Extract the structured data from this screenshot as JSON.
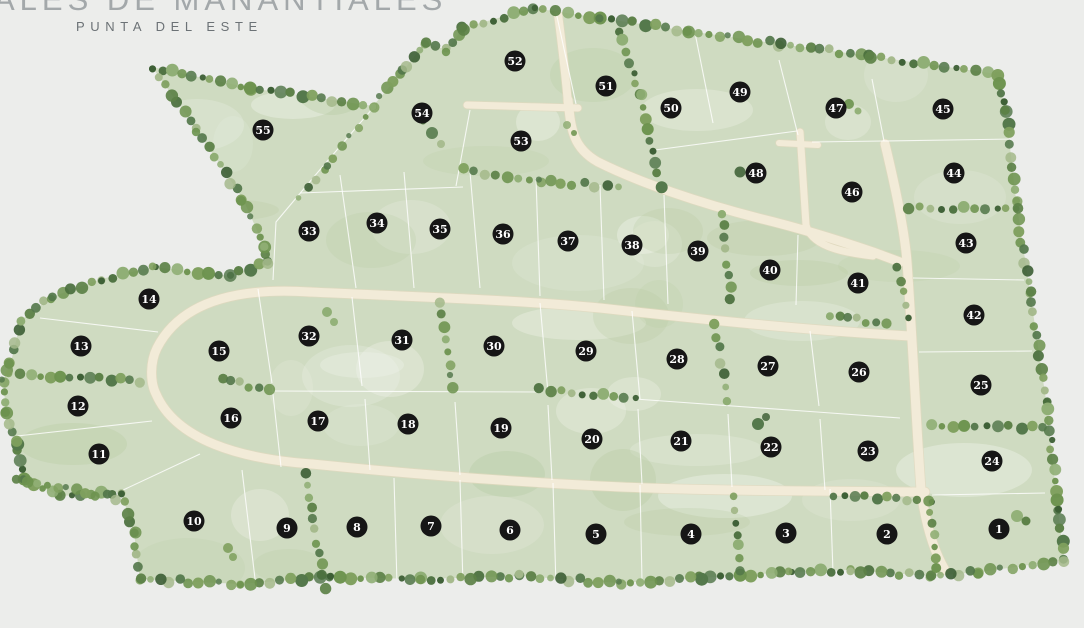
{
  "brand": {
    "title_fragment": "ALES DE MANANTIALES",
    "subtitle": "PUNTA DEL ESTE"
  },
  "map": {
    "background": "#ecedeb",
    "terrain_fill": "#cfdbc1",
    "road_fill": "#f2ebd8",
    "road_edge": "#e2d9be",
    "line_color": "#ffffff",
    "marker_fill": "#161616",
    "marker_text": "#ffffff",
    "tree_palette": [
      "#4a6f3d",
      "#5c8147",
      "#6d934f",
      "#3d5f35",
      "#7fa05e",
      "#8fae74",
      "#53774a",
      "#a4b98b"
    ],
    "boundary": [
      [
        152,
        67
      ],
      [
        250,
        88
      ],
      [
        373,
        106
      ],
      [
        402,
        72
      ],
      [
        425,
        43
      ],
      [
        447,
        50
      ],
      [
        463,
        28
      ],
      [
        533,
        8
      ],
      [
        600,
        18
      ],
      [
        688,
        31
      ],
      [
        780,
        44
      ],
      [
        870,
        56
      ],
      [
        997,
        74
      ],
      [
        1006,
        112
      ],
      [
        1016,
        200
      ],
      [
        1030,
        292
      ],
      [
        1046,
        400
      ],
      [
        1058,
        510
      ],
      [
        1064,
        560
      ],
      [
        980,
        572
      ],
      [
        930,
        576
      ],
      [
        850,
        570
      ],
      [
        790,
        572
      ],
      [
        700,
        578
      ],
      [
        620,
        583
      ],
      [
        520,
        576
      ],
      [
        420,
        579
      ],
      [
        330,
        577
      ],
      [
        240,
        584
      ],
      [
        140,
        579
      ],
      [
        134,
        533
      ],
      [
        121,
        492
      ],
      [
        60,
        496
      ],
      [
        24,
        479
      ],
      [
        16,
        443
      ],
      [
        6,
        412
      ],
      [
        3,
        381
      ],
      [
        11,
        362
      ],
      [
        21,
        320
      ],
      [
        52,
        297
      ],
      [
        101,
        279
      ],
      [
        154,
        267
      ],
      [
        230,
        276
      ],
      [
        268,
        262
      ],
      [
        264,
        246
      ],
      [
        243,
        199
      ],
      [
        197,
        130
      ]
    ],
    "roads": [
      {
        "d": "M558,14 C562,45 566,80 568,104",
        "w": 8
      },
      {
        "d": "M467,105 L578,108",
        "w": 7
      },
      {
        "d": "M568,100 C571,130 573,148 598,162 C640,183 700,203 758,218 C800,228 838,240 873,252 L900,262",
        "w": 9
      },
      {
        "d": "M800,132 L806,225 C811,245 838,252 873,256",
        "w": 7
      },
      {
        "d": "M779,143 L818,145",
        "w": 6
      },
      {
        "d": "M310,292 C420,297 520,300 600,308 C690,318 800,330 910,336",
        "w": 9
      },
      {
        "d": "M885,144 C898,198 905,235 907,262 C912,330 916,420 921,490 C925,520 932,548 945,570",
        "w": 9
      },
      {
        "d": "M312,464 C420,475 520,482 600,486 C700,491 820,491 925,492",
        "w": 9
      },
      {
        "d": "M310,292 C235,287 180,303 157,348 C150,362 150,382 156,394 C176,440 240,459 312,464",
        "w": 9
      }
    ],
    "lot_lines": [
      "M556,12 L576,104",
      "M695,33 L713,123",
      "M779,60 L798,135",
      "M872,79 L884,141",
      "M884,141 L1014,139",
      "M655,150 L797,131",
      "M812,142 L884,141",
      "M373,108 L318,172 L276,222 L273,280",
      "M470,110 L456,186",
      "M300,193 L463,187",
      "M340,175 L356,288",
      "M404,172 L414,288",
      "M470,172 L480,288",
      "M536,178 L540,296",
      "M600,185 L604,300",
      "M664,195 L668,304",
      "M798,235 L796,305",
      "M913,278 L1024,280",
      "M919,352 L1032,351",
      "M932,495 L1045,493",
      "M258,289 L272,383",
      "M352,297 L362,386",
      "M540,303 L548,393",
      "M632,311 L640,399",
      "M810,331 L819,406",
      "M270,391 L540,392",
      "M635,399 L817,412 L900,418",
      "M272,385 L281,467",
      "M365,399 L370,470",
      "M455,402 L460,475",
      "M548,405 L552,480",
      "M638,409 L642,484",
      "M728,414 L732,487",
      "M820,419 L825,490",
      "M40,318 L158,332",
      "M8,437 L152,421",
      "M121,491 L200,454",
      "M242,470 L256,587",
      "M394,478 L397,584",
      "M460,480 L463,585",
      "M553,483 L556,586",
      "M640,485 L642,581",
      "M830,489 L833,572"
    ],
    "tree_lines": [
      {
        "pts": [
          [
            618,
            30
          ],
          [
            640,
            95
          ],
          [
            660,
            186
          ]
        ],
        "gap": 12,
        "rmin": 3,
        "rmax": 6
      },
      {
        "pts": [
          [
            463,
            170
          ],
          [
            540,
            181
          ],
          [
            618,
            187
          ]
        ],
        "gap": 11,
        "rmin": 3,
        "rmax": 6
      },
      {
        "pts": [
          [
            722,
            213
          ],
          [
            731,
            300
          ]
        ],
        "gap": 12,
        "rmin": 3,
        "rmax": 6
      },
      {
        "pts": [
          [
            908,
            207
          ],
          [
            1018,
            209
          ]
        ],
        "gap": 11,
        "rmin": 3,
        "rmax": 6
      },
      {
        "pts": [
          [
            930,
            425
          ],
          [
            1043,
            428
          ]
        ],
        "gap": 11,
        "rmin": 3,
        "rmax": 6
      },
      {
        "pts": [
          [
            440,
            301
          ],
          [
            453,
            389
          ]
        ],
        "gap": 12,
        "rmin": 3,
        "rmax": 6
      },
      {
        "pts": [
          [
            716,
            323
          ],
          [
            727,
            400
          ]
        ],
        "gap": 12,
        "rmin": 3,
        "rmax": 6
      },
      {
        "pts": [
          [
            222,
            379
          ],
          [
            268,
            390
          ]
        ],
        "gap": 10,
        "rmin": 3,
        "rmax": 6
      },
      {
        "pts": [
          [
            540,
            389
          ],
          [
            634,
            398
          ]
        ],
        "gap": 10,
        "rmin": 3,
        "rmax": 6
      },
      {
        "pts": [
          [
            10,
            374
          ],
          [
            140,
            381
          ]
        ],
        "gap": 10,
        "rmin": 3,
        "rmax": 6
      },
      {
        "pts": [
          [
            17,
            479
          ],
          [
            117,
            498
          ]
        ],
        "gap": 10,
        "rmin": 3,
        "rmax": 6
      },
      {
        "pts": [
          [
            305,
            474
          ],
          [
            325,
            587
          ]
        ],
        "gap": 12,
        "rmin": 3,
        "rmax": 6
      },
      {
        "pts": [
          [
            733,
            497
          ],
          [
            740,
            570
          ]
        ],
        "gap": 12,
        "rmin": 3,
        "rmax": 5.5
      },
      {
        "pts": [
          [
            930,
            502
          ],
          [
            936,
            568
          ]
        ],
        "gap": 12,
        "rmin": 3,
        "rmax": 5
      },
      {
        "pts": [
          [
            834,
            496
          ],
          [
            928,
            500
          ]
        ],
        "gap": 11,
        "rmin": 3,
        "rmax": 5.5
      },
      {
        "pts": [
          [
            373,
            106
          ],
          [
            327,
            168
          ],
          [
            298,
            198
          ]
        ],
        "gap": 13,
        "rmin": 2.5,
        "rmax": 5
      },
      {
        "pts": [
          [
            830,
            315
          ],
          [
            885,
            324
          ]
        ],
        "gap": 10,
        "rmin": 3,
        "rmax": 5.5
      },
      {
        "pts": [
          [
            898,
            268
          ],
          [
            908,
            316
          ]
        ],
        "gap": 11,
        "rmin": 3,
        "rmax": 5
      }
    ],
    "trees": [
      [
        758,
        424,
        6
      ],
      [
        766,
        417,
        4
      ],
      [
        1017,
        516,
        6
      ],
      [
        1026,
        521,
        4.5
      ],
      [
        327,
        312,
        5
      ],
      [
        334,
        322,
        4
      ],
      [
        740,
        172,
        5.5
      ],
      [
        849,
        104,
        5
      ],
      [
        858,
        111,
        3.5
      ],
      [
        432,
        133,
        6
      ],
      [
        441,
        144,
        4
      ],
      [
        423,
        121,
        3.5
      ],
      [
        567,
        125,
        4
      ],
      [
        574,
        133,
        3
      ],
      [
        228,
        548,
        5
      ],
      [
        233,
        557,
        4
      ]
    ],
    "lots": [
      {
        "n": 1,
        "x": 999,
        "y": 529
      },
      {
        "n": 2,
        "x": 887,
        "y": 534
      },
      {
        "n": 3,
        "x": 786,
        "y": 533
      },
      {
        "n": 4,
        "x": 691,
        "y": 534
      },
      {
        "n": 5,
        "x": 596,
        "y": 534
      },
      {
        "n": 6,
        "x": 510,
        "y": 530
      },
      {
        "n": 7,
        "x": 431,
        "y": 526
      },
      {
        "n": 8,
        "x": 357,
        "y": 527
      },
      {
        "n": 9,
        "x": 287,
        "y": 528
      },
      {
        "n": 10,
        "x": 194,
        "y": 521
      },
      {
        "n": 11,
        "x": 99,
        "y": 454
      },
      {
        "n": 12,
        "x": 78,
        "y": 406
      },
      {
        "n": 13,
        "x": 81,
        "y": 346
      },
      {
        "n": 14,
        "x": 149,
        "y": 299
      },
      {
        "n": 15,
        "x": 219,
        "y": 351
      },
      {
        "n": 16,
        "x": 231,
        "y": 418
      },
      {
        "n": 17,
        "x": 318,
        "y": 421
      },
      {
        "n": 18,
        "x": 408,
        "y": 424
      },
      {
        "n": 19,
        "x": 501,
        "y": 428
      },
      {
        "n": 20,
        "x": 592,
        "y": 439
      },
      {
        "n": 21,
        "x": 681,
        "y": 441
      },
      {
        "n": 22,
        "x": 771,
        "y": 447
      },
      {
        "n": 23,
        "x": 868,
        "y": 451
      },
      {
        "n": 24,
        "x": 992,
        "y": 461
      },
      {
        "n": 25,
        "x": 981,
        "y": 385
      },
      {
        "n": 26,
        "x": 859,
        "y": 372
      },
      {
        "n": 27,
        "x": 768,
        "y": 366
      },
      {
        "n": 28,
        "x": 677,
        "y": 359
      },
      {
        "n": 29,
        "x": 586,
        "y": 351
      },
      {
        "n": 30,
        "x": 494,
        "y": 346
      },
      {
        "n": 31,
        "x": 402,
        "y": 340
      },
      {
        "n": 32,
        "x": 309,
        "y": 336
      },
      {
        "n": 33,
        "x": 309,
        "y": 231
      },
      {
        "n": 34,
        "x": 377,
        "y": 223
      },
      {
        "n": 35,
        "x": 440,
        "y": 229
      },
      {
        "n": 36,
        "x": 503,
        "y": 234
      },
      {
        "n": 37,
        "x": 568,
        "y": 241
      },
      {
        "n": 38,
        "x": 632,
        "y": 245
      },
      {
        "n": 39,
        "x": 698,
        "y": 251
      },
      {
        "n": 40,
        "x": 770,
        "y": 270
      },
      {
        "n": 41,
        "x": 858,
        "y": 283
      },
      {
        "n": 42,
        "x": 974,
        "y": 315
      },
      {
        "n": 43,
        "x": 966,
        "y": 243
      },
      {
        "n": 44,
        "x": 954,
        "y": 173
      },
      {
        "n": 45,
        "x": 943,
        "y": 109
      },
      {
        "n": 46,
        "x": 852,
        "y": 192
      },
      {
        "n": 47,
        "x": 836,
        "y": 108
      },
      {
        "n": 48,
        "x": 756,
        "y": 173
      },
      {
        "n": 49,
        "x": 740,
        "y": 92
      },
      {
        "n": 50,
        "x": 671,
        "y": 108
      },
      {
        "n": 51,
        "x": 606,
        "y": 86
      },
      {
        "n": 52,
        "x": 515,
        "y": 61
      },
      {
        "n": 53,
        "x": 521,
        "y": 141
      },
      {
        "n": 54,
        "x": 422,
        "y": 113
      },
      {
        "n": 55,
        "x": 263,
        "y": 130
      }
    ]
  }
}
